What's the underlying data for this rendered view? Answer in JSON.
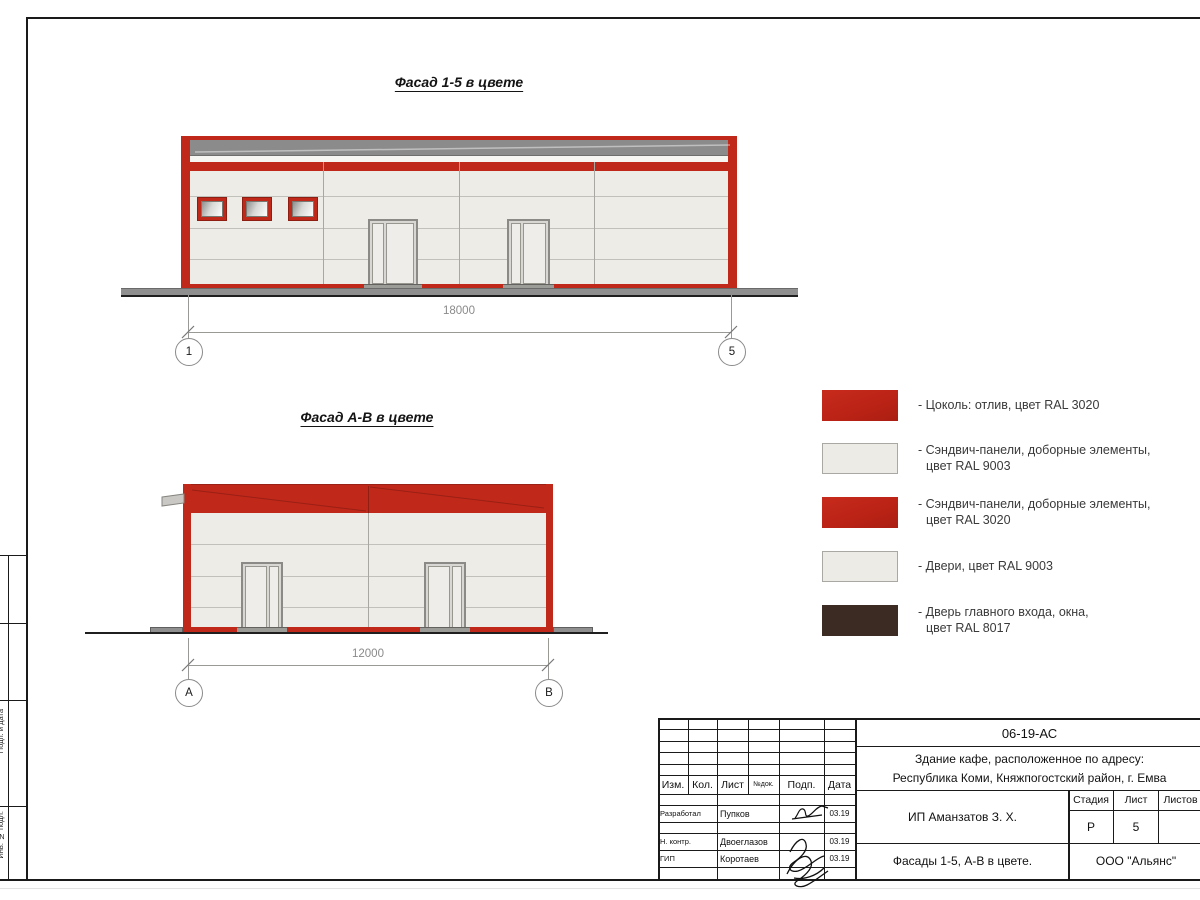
{
  "colors": {
    "red_ral3020": "#c0281a",
    "panel_ral9003": "#edece7",
    "dark_ral8017": "#3b2b23",
    "parapet_gray": "#8b8b8b",
    "ground_gray": "#8f8f8f"
  },
  "facade_top": {
    "title": "Фасад 1-5 в цвете",
    "dimension": "18000",
    "axis_left": "1",
    "axis_right": "5"
  },
  "facade_bottom": {
    "title": "Фасад А-В в цвете",
    "dimension": "12000",
    "axis_left": "А",
    "axis_right": "В"
  },
  "legend": {
    "items": [
      {
        "line1": "- Цоколь: отлив, цвет RAL 3020",
        "line2": ""
      },
      {
        "line1": "- Сэндвич-панели, доборные элементы,",
        "line2": "цвет RAL 9003"
      },
      {
        "line1": "- Сэндвич-панели, доборные элементы,",
        "line2": "цвет RAL 3020"
      },
      {
        "line1": "- Двери, цвет RAL 9003",
        "line2": ""
      },
      {
        "line1": "- Дверь главного входа, окна,",
        "line2": "цвет RAL 8017"
      }
    ]
  },
  "title_block": {
    "doc_code": "06-19-АС",
    "project_line1": "Здание кафе, расположенное по адресу:",
    "project_line2": "Республика Коми, Княжпогостский район, г. Емва",
    "client": "ИП Аманзатов З. Х.",
    "sheet_title": "Фасады 1-5, А-В в цвете.",
    "company": "ООО \"Альянс\"",
    "col_izm": "Изм.",
    "col_kol": "Кол.",
    "col_list": "Лист",
    "col_ndok": "№док.",
    "col_podp": "Подп.",
    "col_data": "Дата",
    "stage_label": "Стадия",
    "sheet_label": "Лист",
    "sheets_label": "Листов",
    "stage_value": "Р",
    "sheet_value": "5",
    "row1_role": "Разработал",
    "row1_name": "Пупков",
    "row1_date": "03.19",
    "row2_role": "Н. контр.",
    "row2_name": "Двоеглазов",
    "row2_date": "03.19",
    "row3_role": "ГИП",
    "row3_name": "Коротаев",
    "row3_date": "03.19"
  },
  "side_strip": {
    "label1": "Согласовано",
    "label2": "Подп. и дата",
    "label3": "Инв. № подл."
  }
}
